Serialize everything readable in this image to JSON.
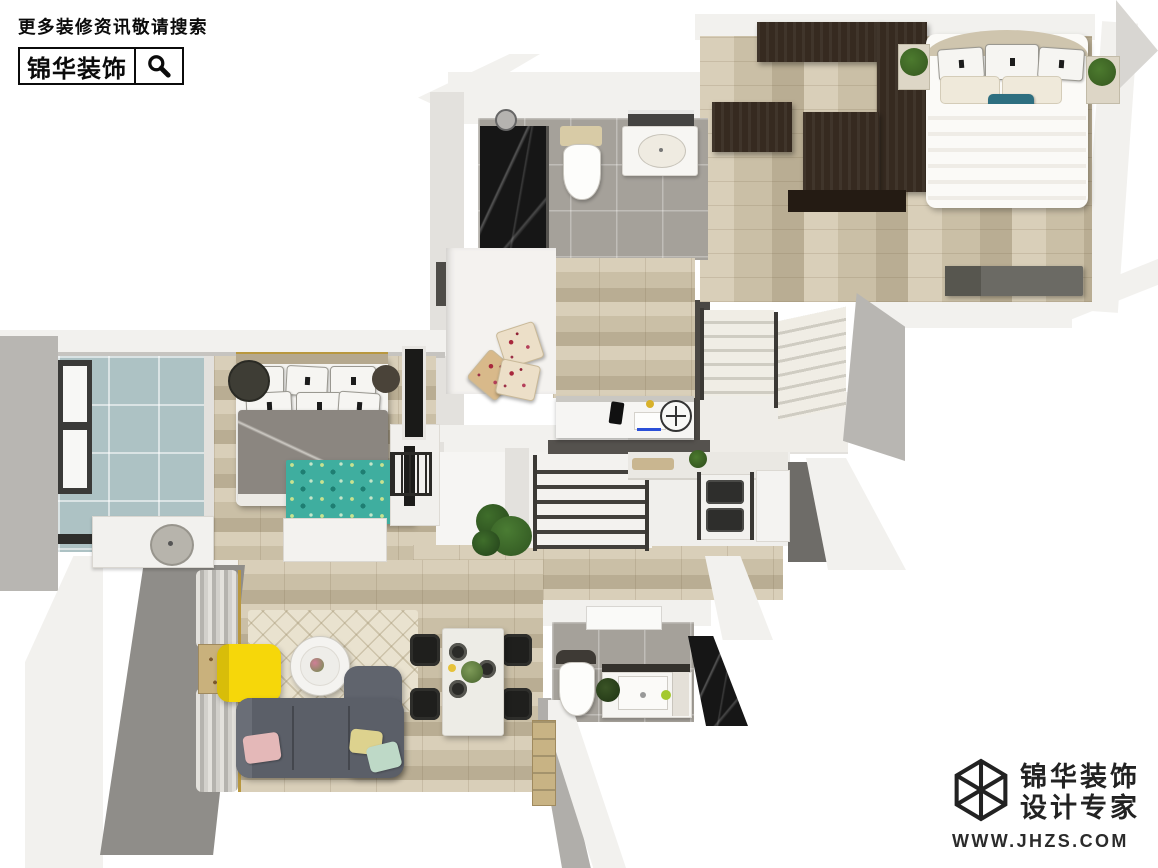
{
  "watermark": {
    "tagline": "更多装修资讯敬请搜索",
    "brand": "锦华装饰",
    "search_icon": "magnifier-icon"
  },
  "logo": {
    "brand": "锦华装饰",
    "subtitle": "设计专家",
    "website": "WWW.JHZS.COM",
    "mark": "wireframe-cube-icon"
  },
  "scene": {
    "type": "3d-floorplan-render",
    "rooms": [
      "bedroom-top-right",
      "bathroom-top",
      "bedroom-second",
      "stair-hall-upper",
      "bedroom-master-left",
      "bathroom-blue-left",
      "stairs-center",
      "kitchen",
      "living-room",
      "dining-area",
      "bathroom-bottom",
      "balcony-left",
      "entry"
    ]
  },
  "colors": {
    "wall_white": "#f2f1ee",
    "wall_light": "#e3e1dd",
    "wall_mid": "#b8b6b2",
    "wall_dark": "#8f8d89",
    "wall_shadow": "#55524e",
    "wood_light": "#d9cfb9",
    "wood_mid": "#cabfa6",
    "wood_dark_plank": "#b9ad93",
    "dark_wood": "#362a20",
    "dark_wood2": "#241b13",
    "tile_gray": "#a5a19a",
    "tile_blue": "#adc2c4",
    "marble_black": "#161616",
    "sofa_gray": "#5b5f68",
    "duvet_gray": "#8b8680",
    "rug_teal": "#3fae9f",
    "rug_cream": "#e9e2cf",
    "accent_yellow": "#f6d70a",
    "pillow_pink": "#e4b8b8",
    "pillow_mint": "#bed9c7",
    "pillow_yellow": "#ddd28e",
    "pillow_teal": "#2e6f80",
    "plant_green": "#35571f",
    "steel_dark": "#3c3935",
    "gold": "#b9983f"
  }
}
